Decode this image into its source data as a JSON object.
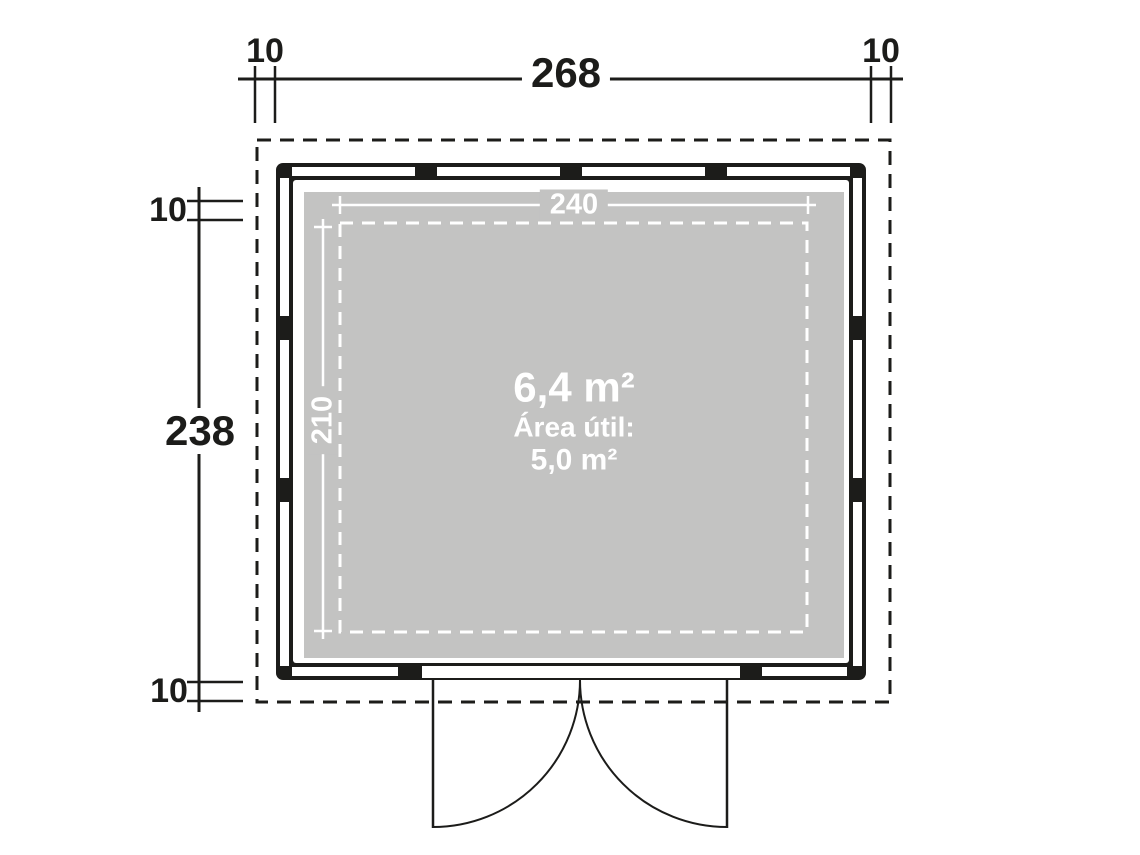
{
  "diagram": {
    "type": "floor-plan",
    "top_dimension": {
      "offset_left": "10",
      "total_width": "268",
      "offset_right": "10"
    },
    "left_dimension": {
      "offset_top": "10",
      "total_depth": "238",
      "offset_bottom": "10"
    },
    "inner_dimensions": {
      "width": "240",
      "depth": "210"
    },
    "area_labels": {
      "gross_area": "6,4 m²",
      "usable_caption": "Área útil:",
      "usable_area": "5,0 m²"
    },
    "colors": {
      "ink_black": "#1c1c1a",
      "floor_gray": "#c3c3c2",
      "line_white": "#ffffff",
      "background": "#ffffff"
    }
  }
}
